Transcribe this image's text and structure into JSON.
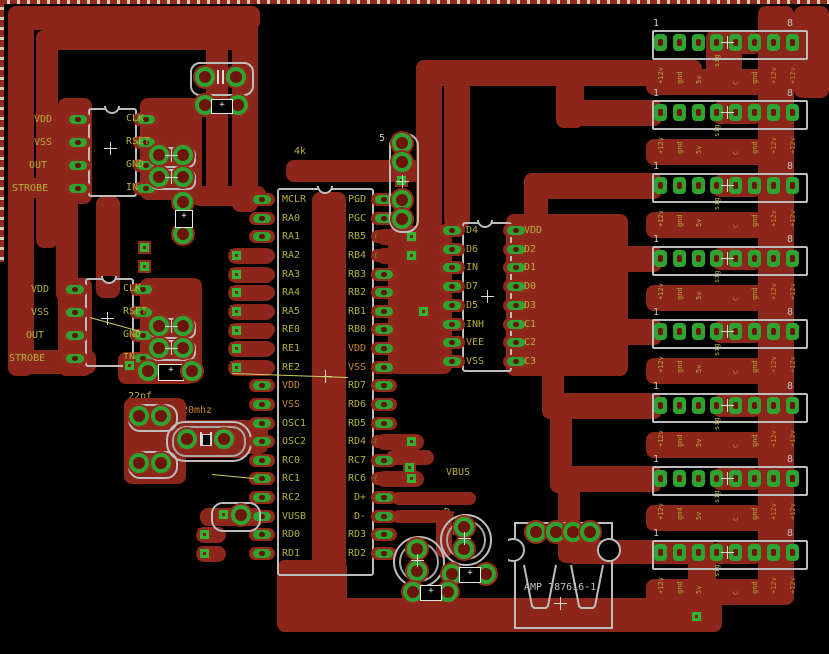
{
  "colors": {
    "copper": "#8c261b",
    "pad_green": "#2fa32f",
    "text_yellow": "#b2b03b",
    "text_orange": "#c9852e",
    "outline_gray": "#c2c2c2",
    "background": "#000000"
  },
  "ic1": {
    "left": [
      "VDD",
      "VSS",
      "OUT",
      "STROBE"
    ],
    "right": [
      "CLK",
      "RSET",
      "GND",
      "IN"
    ]
  },
  "ic2": {
    "left": [
      "VDD",
      "VSS",
      "OUT",
      "STROBE"
    ],
    "right": [
      "CLK",
      "RSET",
      "GND",
      "IN"
    ]
  },
  "mcu": {
    "left": [
      "MCLR",
      "RA0",
      "RA1",
      "RA2",
      "RA3",
      "RA4",
      "RA5",
      "RE0",
      "RE1",
      "RE2",
      "VDD",
      "VSS",
      "OSC1",
      "OSC2",
      "RC0",
      "RC1",
      "RC2",
      "VUSB",
      "RD0",
      "RD1"
    ],
    "right": [
      "PGD",
      "PGC",
      "RB5",
      "RB4",
      "RB3",
      "RB2",
      "RB1",
      "RB0",
      "VDD",
      "VSS",
      "RD7",
      "RD6",
      "RD5",
      "RD4",
      "RC7",
      "RC6",
      "D+",
      "D-",
      "RD3",
      "RD2"
    ],
    "scl": "SCL",
    "sdo": "SDO"
  },
  "mux": {
    "left": [
      "D4",
      "D6",
      "IN",
      "D7",
      "D5",
      "INH",
      "VEE",
      "VSS"
    ],
    "right": [
      "VDD",
      "D2",
      "D1",
      "D0",
      "D3",
      "C1",
      "C2",
      "C3"
    ]
  },
  "icsp": {
    "top": "5",
    "bottom": "1"
  },
  "pg_header": {
    "pin1": "1"
  },
  "parts": {
    "r_pullup": "4k",
    "cap1": "22pf",
    "cap2": "22pf",
    "xtal": "20mhz"
  },
  "usb": {
    "vbus": "VBUS",
    "dplus": "D+",
    "dminus": "D-",
    "gnd": "GND",
    "part": "AMP 787616-1"
  },
  "headers": {
    "first_pin": "1",
    "last_pin": "8",
    "row_count": 8,
    "pin_labels": [
      "+12v",
      "gnd",
      "5v",
      "sig",
      "C",
      "gnd",
      "+12v",
      "+12v"
    ]
  }
}
